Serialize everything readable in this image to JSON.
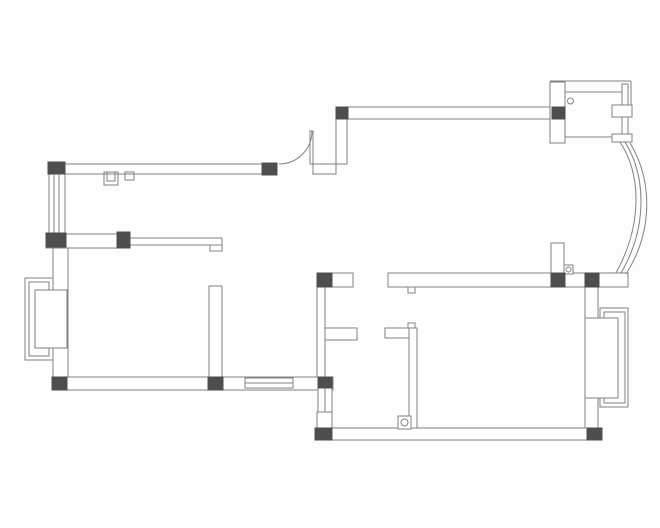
{
  "meta": {
    "description": "apartment-floor-plan-line-drawing",
    "canvas": {
      "width": 660,
      "height": 528,
      "background": "#fdfdfd"
    }
  },
  "style": {
    "line_color": "#818181",
    "wall_fill": "#ffffff",
    "column_fill": "#4e4e4e",
    "line_width": 1
  },
  "plan": {
    "elements": [
      {
        "name": "top-left-exterior-wall",
        "type": "rect",
        "x": 48,
        "y": 164,
        "w": 229,
        "h": 10,
        "fill": "wall"
      },
      {
        "name": "door-jamb-wall",
        "type": "rect",
        "x": 313,
        "y": 164,
        "w": 23,
        "h": 10,
        "fill": "wall"
      },
      {
        "name": "door-offset-wall-vertical",
        "type": "rect",
        "x": 336,
        "y": 119,
        "w": 11,
        "h": 45,
        "fill": "wall"
      },
      {
        "name": "top-right-exterior-wall",
        "type": "rect",
        "x": 336,
        "y": 107,
        "w": 229,
        "h": 12,
        "fill": "wall"
      },
      {
        "name": "left-exterior-wall-lower",
        "type": "rect",
        "x": 53,
        "y": 247,
        "w": 15,
        "h": 130,
        "fill": "wall"
      },
      {
        "name": "left-mid-partition-wall",
        "type": "rect",
        "x": 46,
        "y": 234,
        "w": 84,
        "h": 14,
        "fill": "wall"
      },
      {
        "name": "middle-partition-wall",
        "type": "rect",
        "x": 209,
        "y": 286,
        "w": 13,
        "h": 92,
        "fill": "wall"
      },
      {
        "name": "bottom-left-exterior-wall",
        "type": "rect",
        "x": 52,
        "y": 377,
        "w": 281,
        "h": 13,
        "fill": "wall"
      },
      {
        "name": "bathroom-left-wall",
        "type": "rect",
        "x": 317,
        "y": 287,
        "w": 8,
        "h": 90,
        "fill": "wall"
      },
      {
        "name": "cross-wall-left-segment",
        "type": "rect",
        "x": 317,
        "y": 273,
        "w": 36,
        "h": 14,
        "fill": "wall"
      },
      {
        "name": "main-cross-wall",
        "type": "rect",
        "x": 388,
        "y": 273,
        "w": 240,
        "h": 14,
        "fill": "wall"
      },
      {
        "name": "bathroom-stub-wall-left",
        "type": "rect",
        "x": 325,
        "y": 328,
        "w": 32,
        "h": 12,
        "fill": "wall"
      },
      {
        "name": "bathroom-stub-wall-right",
        "type": "rect",
        "x": 385,
        "y": 328,
        "w": 28,
        "h": 10,
        "fill": "wall"
      },
      {
        "name": "bathroom-partition-vertical",
        "type": "rect",
        "x": 409,
        "y": 328,
        "w": 8,
        "h": 100,
        "fill": "wall"
      },
      {
        "name": "lower-left-wall-vertical",
        "type": "rect",
        "x": 317,
        "y": 412,
        "w": 15,
        "h": 16,
        "fill": "wall"
      },
      {
        "name": "bottom-right-exterior-wall",
        "type": "rect",
        "x": 315,
        "y": 428,
        "w": 287,
        "h": 12,
        "fill": "wall"
      },
      {
        "name": "right-exterior-wall",
        "type": "rect",
        "x": 585,
        "y": 287,
        "w": 13,
        "h": 141,
        "fill": "wall"
      },
      {
        "name": "hall-door-stub-wall",
        "type": "rect",
        "x": 551,
        "y": 243,
        "w": 13,
        "h": 31,
        "fill": "wall"
      },
      {
        "name": "entry-left-wall",
        "type": "rect",
        "x": 550,
        "y": 82,
        "w": 15,
        "h": 61,
        "fill": "wall"
      },
      {
        "name": "left-bay-window-outer",
        "type": "rect",
        "x": 25,
        "y": 278,
        "w": 28,
        "h": 82,
        "fill": "none"
      },
      {
        "name": "left-bay-window-inner",
        "type": "rect",
        "x": 29,
        "y": 282,
        "w": 20,
        "h": 74,
        "fill": "none"
      },
      {
        "name": "left-bay-window-sash",
        "type": "rect",
        "x": 35,
        "y": 290,
        "w": 32,
        "h": 58,
        "fill": "wall"
      },
      {
        "name": "right-bay-window-outer",
        "type": "rect",
        "x": 600,
        "y": 308,
        "w": 28,
        "h": 99,
        "fill": "none"
      },
      {
        "name": "right-bay-window-inner",
        "type": "rect",
        "x": 604,
        "y": 312,
        "w": 21,
        "h": 91,
        "fill": "none"
      },
      {
        "name": "right-bay-window-sash",
        "type": "rect",
        "x": 585,
        "y": 318,
        "w": 33,
        "h": 80,
        "fill": "wall"
      },
      {
        "name": "left-window-frame",
        "type": "rect",
        "x": 49,
        "y": 174,
        "w": 16,
        "h": 59,
        "fill": "wall"
      },
      {
        "name": "left-window-glazing-1",
        "type": "line",
        "x1": 54,
        "y1": 174,
        "x2": 54,
        "y2": 233
      },
      {
        "name": "left-window-glazing-2",
        "type": "line",
        "x1": 59,
        "y1": 174,
        "x2": 59,
        "y2": 233
      },
      {
        "name": "bottom-window-frame",
        "type": "rect",
        "x": 245,
        "y": 378,
        "w": 48,
        "h": 10,
        "fill": "wall"
      },
      {
        "name": "bottom-window-glazing",
        "type": "line",
        "x1": 245,
        "y1": 383,
        "x2": 293,
        "y2": 383
      },
      {
        "name": "small-side-window-frame",
        "type": "rect",
        "x": 318,
        "y": 388,
        "w": 14,
        "h": 24,
        "fill": "wall"
      },
      {
        "name": "small-side-window-glazing",
        "type": "line",
        "x1": 325,
        "y1": 388,
        "x2": 325,
        "y2": 412
      },
      {
        "name": "entry-top-edge-line",
        "type": "line",
        "x1": 550,
        "y1": 81,
        "x2": 631,
        "y2": 81
      },
      {
        "name": "entry-right-edge-line",
        "type": "line",
        "x1": 631,
        "y1": 81,
        "x2": 631,
        "y2": 105
      },
      {
        "name": "entry-door-track",
        "type": "rect",
        "x": 622,
        "y": 84,
        "w": 6,
        "h": 58,
        "fill": "none"
      },
      {
        "name": "entry-inner-top-line",
        "type": "line",
        "x1": 565,
        "y1": 92,
        "x2": 622,
        "y2": 92
      },
      {
        "name": "entry-inner-bottom-line",
        "type": "line",
        "x1": 565,
        "y1": 137,
        "x2": 612,
        "y2": 137
      },
      {
        "name": "entry-door-panel-upper",
        "type": "rect",
        "x": 612,
        "y": 105,
        "w": 20,
        "h": 12,
        "fill": "wall"
      },
      {
        "name": "entry-door-panel-lower",
        "type": "rect",
        "x": 612,
        "y": 134,
        "w": 20,
        "h": 8,
        "fill": "wall"
      },
      {
        "name": "entry-pivot-circle",
        "type": "circle",
        "cx": 570.5,
        "cy": 101,
        "r": 3
      },
      {
        "name": "curved-bay-window-line-1",
        "type": "path",
        "d": "M 620 142 C 641 174 643 224 616 273"
      },
      {
        "name": "curved-bay-window-line-2",
        "type": "path",
        "d": "M 625 142 C 646 176 648 227 621 273"
      },
      {
        "name": "curved-bay-window-line-3",
        "type": "path",
        "d": "M 630 143 C 652 179 654 230 626 274"
      },
      {
        "name": "hall-door-leaf",
        "type": "rect",
        "x": 310,
        "y": 131,
        "w": 3,
        "h": 33,
        "fill": "wall"
      },
      {
        "name": "hall-door-swing-arc",
        "type": "path",
        "d": "M 279 164 A 33 33 0 0 0 312 131"
      },
      {
        "name": "bedroom-door-pivot-box",
        "type": "rect",
        "x": 398,
        "y": 416,
        "w": 13,
        "h": 13,
        "fill": "wall"
      },
      {
        "name": "bedroom-door-pivot-circle",
        "type": "circle",
        "cx": 404.5,
        "cy": 422.5,
        "r": 3.5
      },
      {
        "name": "hall-door-pivot-box",
        "type": "rect",
        "x": 564,
        "y": 265,
        "w": 9,
        "h": 9,
        "fill": "wall"
      },
      {
        "name": "hall-door-pivot-circle",
        "type": "circle",
        "cx": 568.5,
        "cy": 269.5,
        "r": 2.5
      },
      {
        "name": "flue-shaft-outer",
        "type": "rect",
        "x": 104,
        "y": 172,
        "w": 14,
        "h": 13,
        "fill": "none"
      },
      {
        "name": "flue-shaft-inner",
        "type": "rect",
        "x": 107,
        "y": 172,
        "w": 8,
        "h": 9,
        "fill": "none"
      },
      {
        "name": "wall-niche-box",
        "type": "rect",
        "x": 125,
        "y": 172,
        "w": 9,
        "h": 8,
        "fill": "none"
      },
      {
        "name": "counter-half-wall",
        "type": "rect",
        "x": 130,
        "y": 238,
        "w": 92,
        "h": 7,
        "fill": "wall"
      },
      {
        "name": "counter-half-wall-hook",
        "type": "rect",
        "x": 210,
        "y": 245,
        "w": 12,
        "h": 6,
        "fill": "wall"
      },
      {
        "name": "door-stop-tab-upper",
        "type": "rect",
        "x": 408,
        "y": 287,
        "w": 7,
        "h": 6,
        "fill": "wall"
      },
      {
        "name": "door-stop-tab-lower",
        "type": "rect",
        "x": 408,
        "y": 323,
        "w": 7,
        "h": 5,
        "fill": "wall"
      },
      {
        "name": "column-top-left-corner",
        "type": "rect",
        "x": 48,
        "y": 162,
        "w": 17,
        "h": 12,
        "fill": "column"
      },
      {
        "name": "column-door-left",
        "type": "rect",
        "x": 262,
        "y": 163,
        "w": 15,
        "h": 12,
        "fill": "column"
      },
      {
        "name": "column-door-right",
        "type": "rect",
        "x": 336,
        "y": 107,
        "w": 12,
        "h": 12,
        "fill": "column"
      },
      {
        "name": "column-entry",
        "type": "rect",
        "x": 552,
        "y": 107,
        "w": 13,
        "h": 12,
        "fill": "column"
      },
      {
        "name": "column-left-mid-a",
        "type": "rect",
        "x": 46,
        "y": 233,
        "w": 20,
        "h": 14,
        "fill": "column"
      },
      {
        "name": "column-left-mid-b",
        "type": "rect",
        "x": 117,
        "y": 232,
        "w": 13,
        "h": 16,
        "fill": "column"
      },
      {
        "name": "column-cross-left",
        "type": "rect",
        "x": 317,
        "y": 273,
        "w": 15,
        "h": 14,
        "fill": "column"
      },
      {
        "name": "column-cross-mid",
        "type": "rect",
        "x": 551,
        "y": 273,
        "w": 14,
        "h": 14,
        "fill": "column"
      },
      {
        "name": "column-cross-right",
        "type": "rect",
        "x": 585,
        "y": 273,
        "w": 14,
        "h": 14,
        "fill": "column"
      },
      {
        "name": "column-bottom-left-corner",
        "type": "rect",
        "x": 52,
        "y": 377,
        "w": 15,
        "h": 13,
        "fill": "column"
      },
      {
        "name": "column-bottom-mid",
        "type": "rect",
        "x": 208,
        "y": 377,
        "w": 15,
        "h": 13,
        "fill": "column"
      },
      {
        "name": "column-bottom-step",
        "type": "rect",
        "x": 318,
        "y": 377,
        "w": 14,
        "h": 11,
        "fill": "column"
      },
      {
        "name": "column-bottom-right-a",
        "type": "rect",
        "x": 315,
        "y": 428,
        "w": 17,
        "h": 12,
        "fill": "column"
      },
      {
        "name": "column-bottom-right-b",
        "type": "rect",
        "x": 587,
        "y": 428,
        "w": 15,
        "h": 12,
        "fill": "column"
      }
    ]
  }
}
